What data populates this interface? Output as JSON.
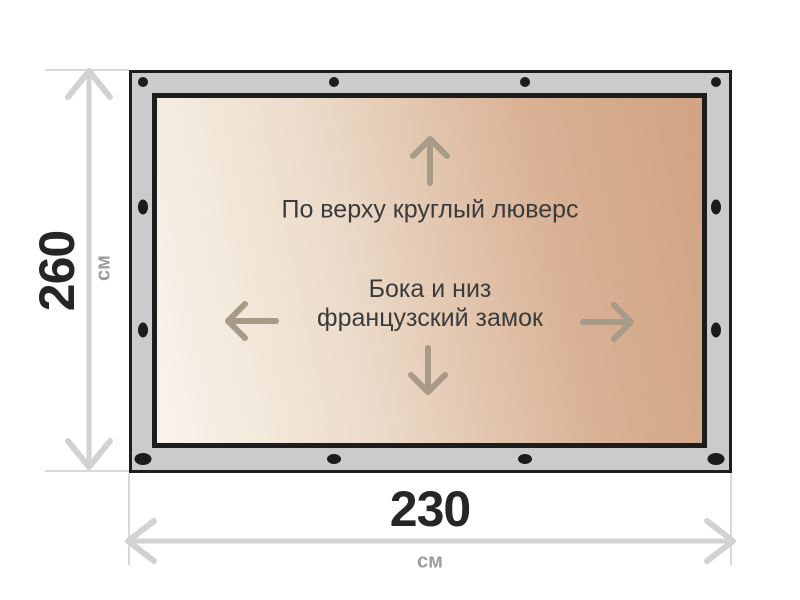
{
  "diagram": {
    "title": "tarp-dimension-diagram",
    "height_dimension": {
      "value": "260",
      "unit": "см"
    },
    "width_dimension": {
      "value": "230",
      "unit": "см"
    },
    "fabric_labels": {
      "top_edge": "По верху круглый люверс",
      "sides_bottom_line1": "Бока и низ",
      "sides_bottom_line2": "французский замок"
    },
    "icons": {
      "up": "up-arrow-icon",
      "left": "left-arrow-icon",
      "right": "right-arrow-icon",
      "down": "down-arrow-icon",
      "grommet": "grommet-dot"
    },
    "colors": {
      "frame_gray": "#c9cbcd",
      "frame_border": "#1d1d1d",
      "fabric_light": "#f9f4ec",
      "fabric_dark": "#d0a384",
      "fabric_arrow": "#a79a87",
      "dimension_line": "#d2d2d2",
      "dimension_text": "#262626",
      "unit_text": "#9c9c9c",
      "grommet": "#1c1c1c"
    },
    "grommet_counts": {
      "top": 4,
      "bottom": 4,
      "left_side": 2,
      "right_side": 2
    }
  }
}
